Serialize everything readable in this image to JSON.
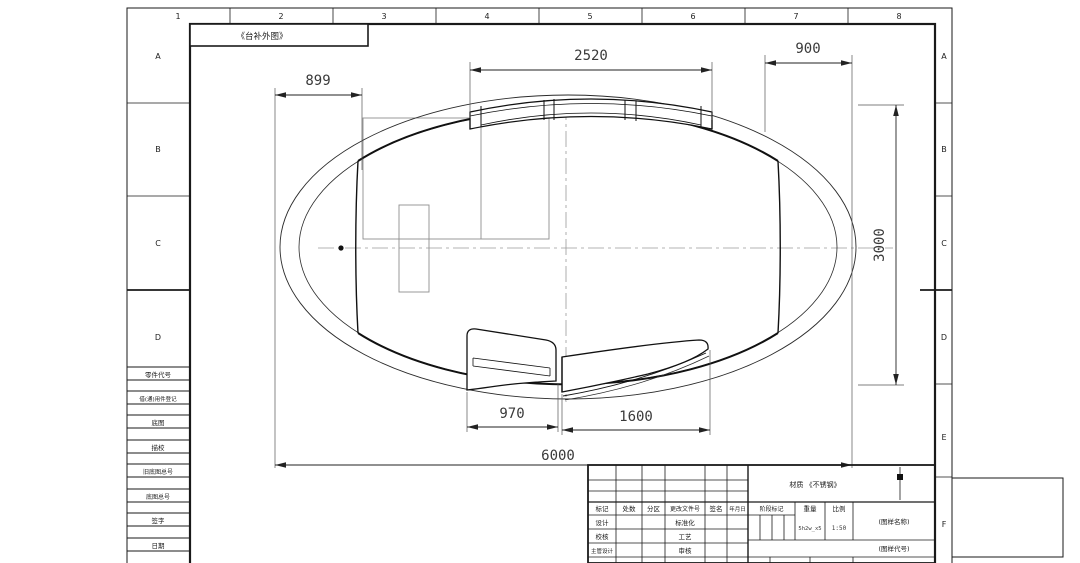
{
  "sheet": {
    "view_label": "《台补外图》",
    "zones": {
      "cols": [
        "1",
        "2",
        "3",
        "4",
        "5",
        "6",
        "7",
        "8"
      ],
      "rows_left": [
        "A",
        "B",
        "C",
        "D"
      ],
      "rows_right": [
        "A",
        "B",
        "C",
        "D",
        "E",
        "F"
      ]
    },
    "left_margin_fields": {
      "f1": "零件代号",
      "f2": "借(通)用件登记",
      "f3": "底图",
      "f4": "描校",
      "f5": "旧底图总号",
      "f6": "底图总号",
      "f7": "签字",
      "f8": "日期"
    }
  },
  "dimensions": {
    "left_offset": "899",
    "top_width": "2520",
    "right_offset": "900",
    "height": "3000",
    "bottom_left": "970",
    "bottom_mid": "1600",
    "total_width": "6000"
  },
  "title_block": {
    "material_note": "材质 《不锈钢》",
    "headers": {
      "h1": "标记",
      "h2": "处数",
      "h3": "分区",
      "h4": "更改文件号",
      "h5": "签名",
      "h6": "年月日"
    },
    "roles": {
      "r1c1": "设计",
      "r1c2": "标准化",
      "r2c1": "校核",
      "r2c2": "工艺",
      "r3c1": "主管设计",
      "r3c2": "审核"
    },
    "stage_mark_label": "阶段标记",
    "weight_label": "重量",
    "scale_label": "比例",
    "weight_value": "5h2w_x5",
    "scale_value": "1:50",
    "drawing_name": "(图样名称)",
    "drawing_code": "(图样代号)"
  }
}
